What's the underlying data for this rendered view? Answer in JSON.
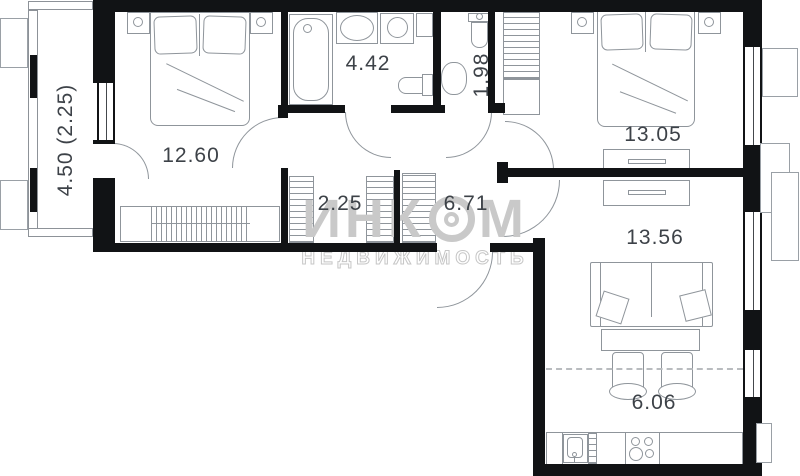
{
  "plan": {
    "labels": {
      "balcony": "4.50 (2.25)",
      "bedroom1": "12.60",
      "bathroom": "4.42",
      "wc": "1.98",
      "closet": "2.25",
      "hallway": "6.71",
      "bedroom2": "13.05",
      "living_room": "13.56",
      "kitchen": "6.06"
    },
    "watermark": {
      "brand_prefix": "ИНК",
      "brand_suffix": "М",
      "subtitle": "НЕДВИЖИМОСТЬ"
    },
    "colors": {
      "wall": "#111315",
      "furniture_line": "#8f959b",
      "label_text": "#3d4248",
      "watermark": "#c9c9c9"
    }
  }
}
